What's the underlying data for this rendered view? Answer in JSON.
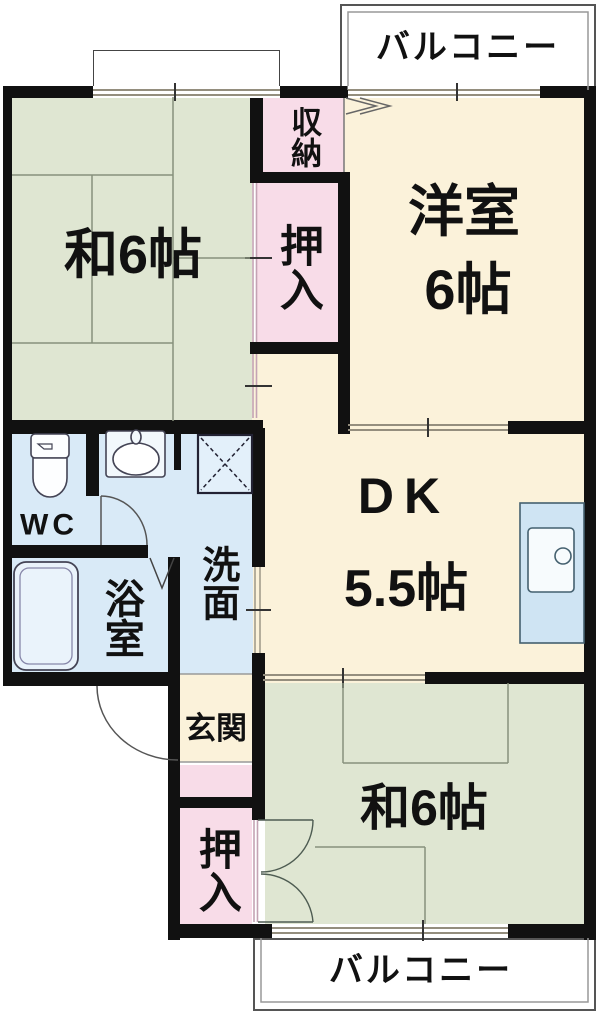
{
  "colors": {
    "tatami_green": "#dfe6d2",
    "western_cream": "#fbf2da",
    "closet_pink": "#f8dce8",
    "wet_blue": "#d9eaf7",
    "wall": "#111111"
  },
  "balconies": {
    "top": {
      "label": "バルコニー"
    },
    "bottom": {
      "label": "バルコニー"
    }
  },
  "rooms": {
    "washitsu_top": {
      "label": "和6帖"
    },
    "youshitsu": {
      "label": "洋室",
      "size": "6帖"
    },
    "dk": {
      "label": "DK",
      "size": "5.5帖"
    },
    "washitsu_bottom": {
      "label": "和6帖"
    },
    "shuno": {
      "label": "収納"
    },
    "oshiire_top": {
      "label": "押入"
    },
    "oshiire_bottom": {
      "label": "押入"
    },
    "genkan": {
      "label": "玄関"
    },
    "senmen": {
      "label": "洗面"
    },
    "yokushitsu": {
      "label": "浴室"
    },
    "wc": {
      "label": "WC"
    }
  },
  "icons": {
    "toilet": "toilet-icon",
    "bathtub": "bathtub-icon",
    "washbasin": "washbasin-icon",
    "washer": "washing-machine-icon",
    "kitchen_sink": "kitchen-sink-icon",
    "doors": "door-swing-arc-icon",
    "windows": "window-double-line-icon"
  }
}
